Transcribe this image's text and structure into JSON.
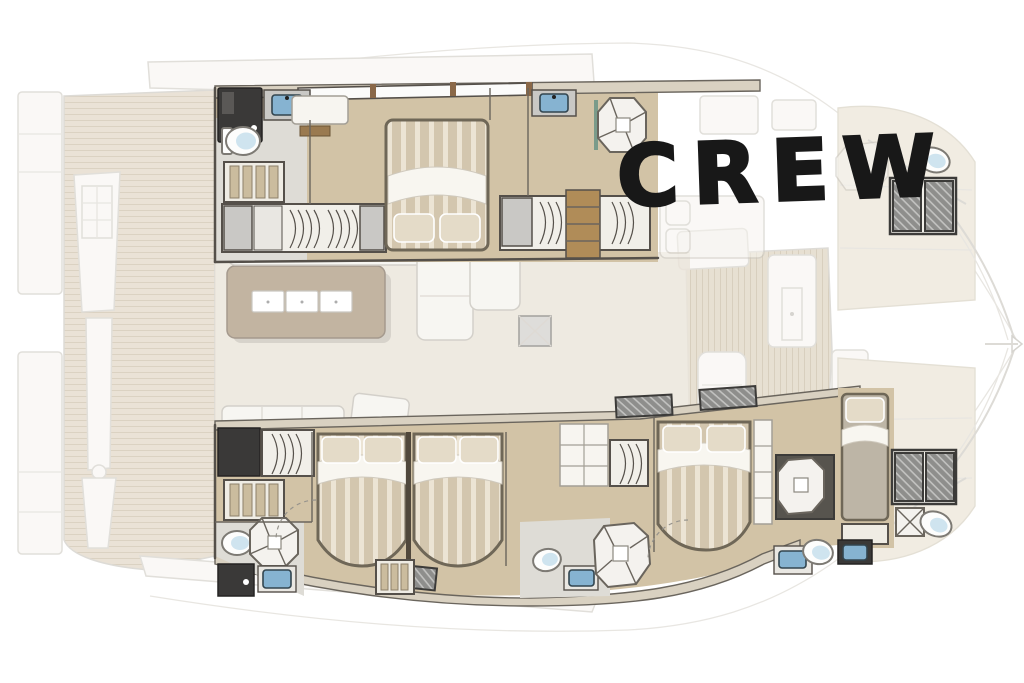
{
  "crew_label": {
    "text": "CREW",
    "color": "#181818"
  },
  "palette": {
    "background": "#ffffff",
    "hull_wood_floor": "#d2c3a6",
    "deck_plank": "#d9ccb6",
    "galley_table": "#b3a28a",
    "mattress_stripe_dark": "#d3c6ae",
    "mattress_stripe_light": "#ece4d4",
    "pillow": "#e4dbc8",
    "dark_unit": "#3a3938",
    "wall_stroke": "#55504a",
    "ghost_line": "#c2beb6",
    "bathroom_floor": "#dedcd6",
    "sink_blue": "#86b3d1",
    "porcelain_blue": "#cfe4ef",
    "saloon_floor": "#ebe5da",
    "hull_wall_band": "#d9d1c1",
    "shelf_wood": "#b08c58",
    "sunpad": "#e6ddcb",
    "window_hatch": "#8e8e8c"
  }
}
